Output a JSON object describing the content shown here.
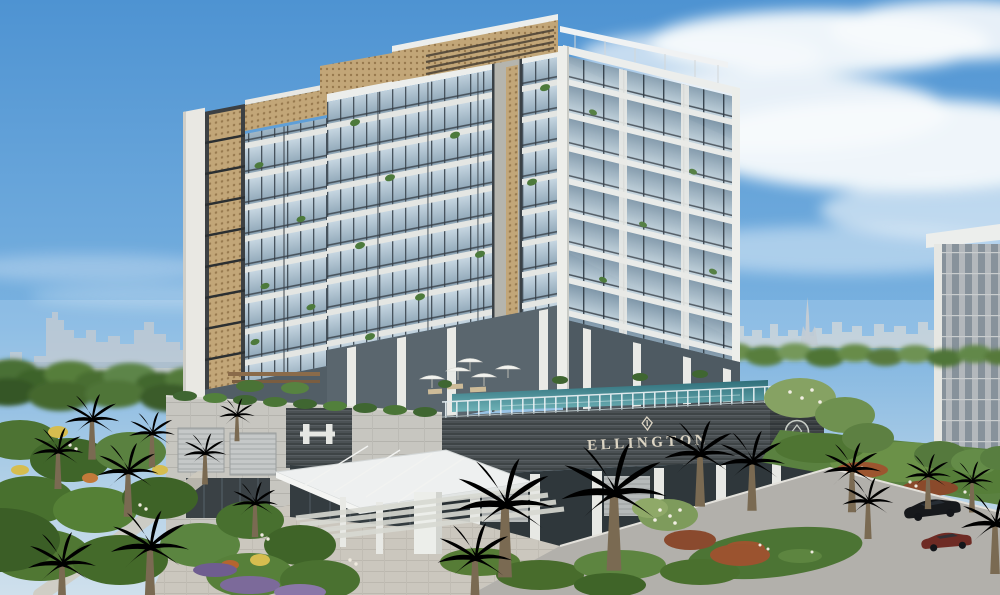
{
  "scene": {
    "type": "architectural-rendering",
    "setting": "Aerial view of a modern luxury residential building with rooftop infinity pool, landscaped palm gardens, entrance driveway and a distant city skyline under a blue sky with wispy clouds",
    "time_of_day": "day"
  },
  "sign": {
    "brand": "ELLINGTON"
  },
  "logos": {
    "sign_mark": "ellington-diamond-mark",
    "corner_emblem": "ellington-circle-emblem",
    "podium_monogram": "eh-monogram"
  },
  "building": {
    "floors_visible": 9,
    "features": [
      "rooftop infinity pool with glass balustrade",
      "pool deck with white umbrellas and loungers",
      "glass balconies with planters",
      "gold perforated screen crown and corner strips",
      "white entrance canopy with cable stays",
      "dark louvered podium band with brand signage"
    ]
  },
  "environment": {
    "skyline": "distant hazy city skyline with one very tall spire",
    "foreground": [
      "fan palms",
      "date palms",
      "flowering shrubs",
      "paved plaza",
      "road with parked cars"
    ],
    "vehicles": [
      {
        "color_name": "white"
      },
      {
        "color_name": "black"
      },
      {
        "color_name": "dark red"
      }
    ]
  },
  "colors": {
    "sky_top": "#4E93D2",
    "sky_horizon": "#C7DCEC",
    "cloud": "#F7FAFC",
    "facade_white": "#E9EAE6",
    "glass_blue": "#A9BFD0",
    "glass_dark": "#6E8496",
    "stone_grey": "#B9B9B3",
    "louver_dark": "#4B5053",
    "gold_screen": "#C2A678",
    "pool_teal": "#3E7D86",
    "palm_green": "#5D7D45",
    "garden_green": "#47702F",
    "sign_text": "#DCD5C4",
    "road_grey": "#B2B0AB",
    "car_black": "#17191C",
    "car_maroon": "#6E2B24",
    "car_white": "#E8E9EA"
  }
}
